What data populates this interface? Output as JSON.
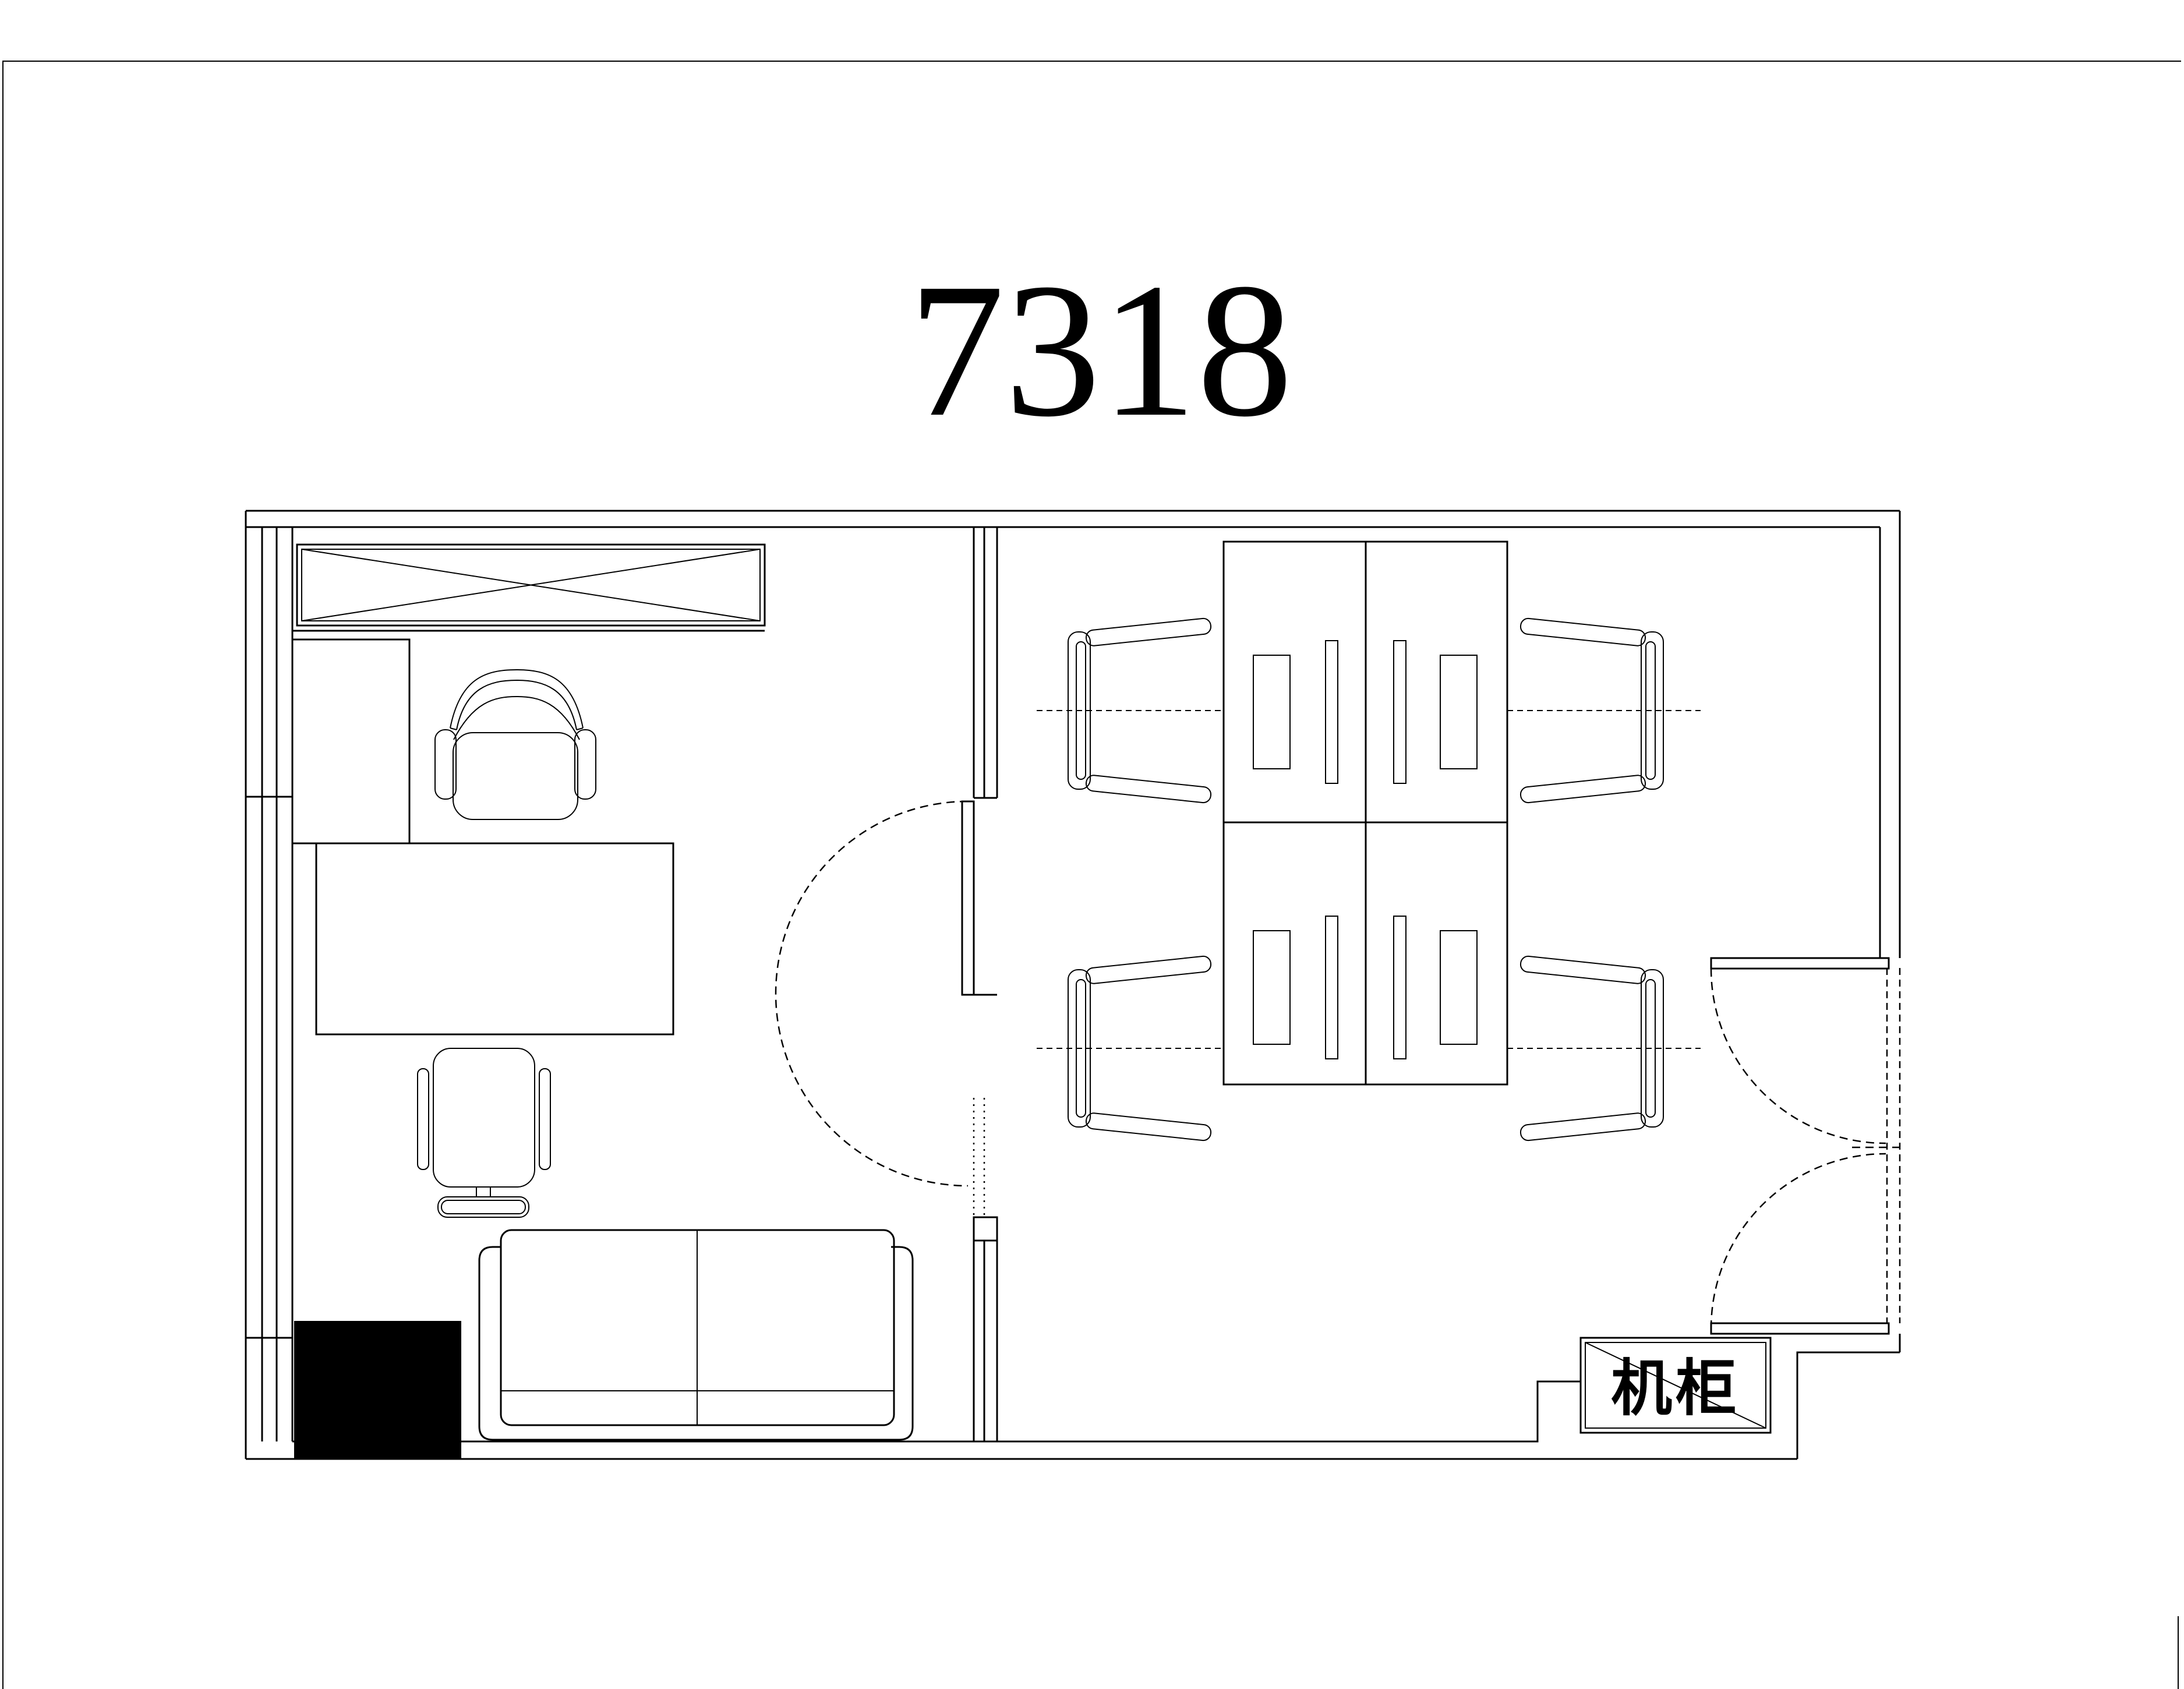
{
  "page": {
    "title": "7318",
    "background_color": "#ffffff",
    "line_color": "#000000"
  },
  "plan": {
    "server_cabinet_label": "机柜",
    "rooms": [
      "private-office",
      "open-office"
    ],
    "elements": [
      "page-border",
      "exterior-walls",
      "window-wall-left",
      "partition-wall",
      "crossed-cabinet",
      "desk-return-panel",
      "executive-desk",
      "executive-chair",
      "guest-chair",
      "two-seat-sofa",
      "structural-column",
      "single-swing-door",
      "workstation-desks-2x2",
      "task-chairs-x4",
      "desk-centerlines",
      "double-entry-door",
      "server-cabinet-box"
    ]
  }
}
